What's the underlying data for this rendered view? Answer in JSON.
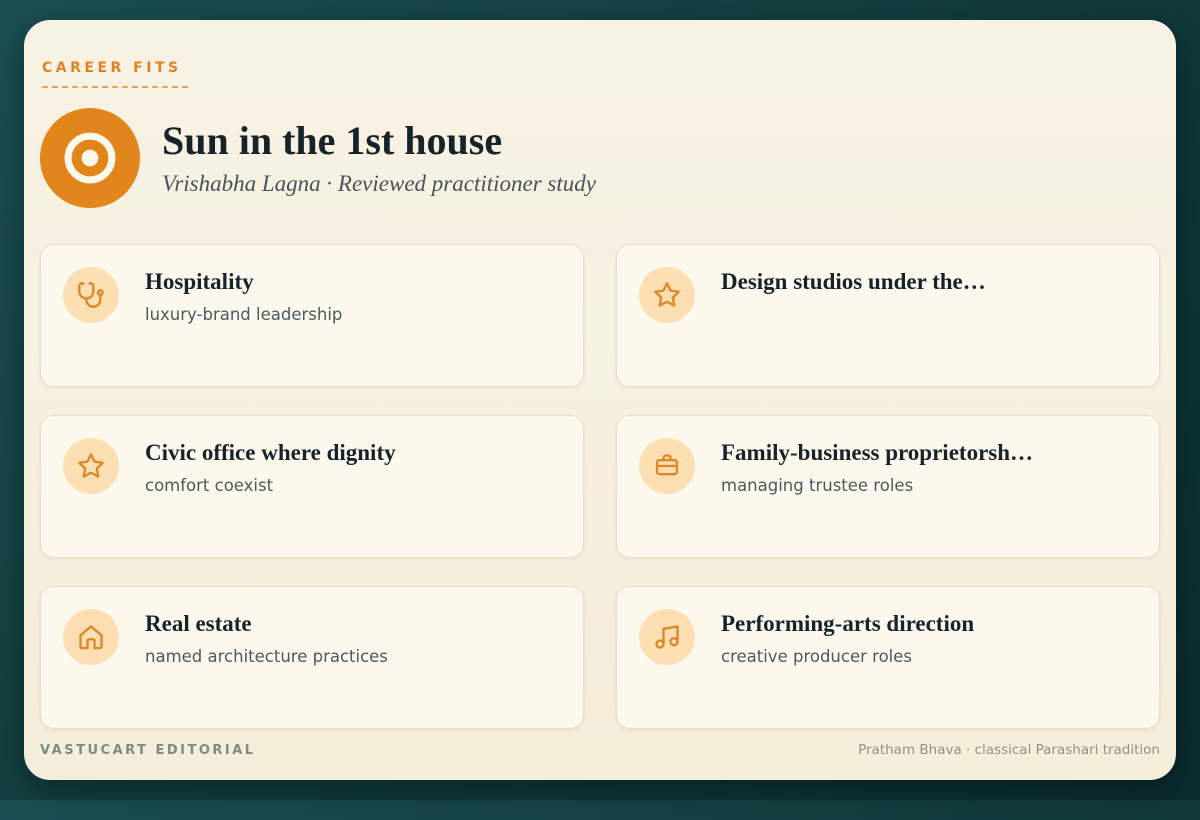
{
  "theme": {
    "accent_orange": "#df8320",
    "icon_stroke": "#dd8824",
    "icon_tile_bg": "#fbdfb2",
    "teal_bg_light": "#1b4f52",
    "teal_bg_dark": "#0b2b2d",
    "board_bg": "#f6f0e1",
    "card_bg": "#fcf8ee",
    "title_color": "#16242a"
  },
  "header": {
    "eyebrow": "CAREER FITS",
    "title": "Sun in the 1st house",
    "subtitle": "Vrishabha Lagna · Reviewed practitioner study",
    "icon": "sun-circle-dot"
  },
  "cards": [
    {
      "icon": "stethoscope",
      "title": "Hospitality",
      "subtitle": "luxury-brand leadership"
    },
    {
      "icon": "star",
      "title": "Design studios under the…",
      "subtitle": ""
    },
    {
      "icon": "star",
      "title": "Civic office where dignity",
      "subtitle": "comfort coexist"
    },
    {
      "icon": "briefcase",
      "title": "Family-business proprietorsh…",
      "subtitle": "managing trustee roles"
    },
    {
      "icon": "home",
      "title": "Real estate",
      "subtitle": "named architecture practices"
    },
    {
      "icon": "music-note",
      "title": "Performing-arts direction",
      "subtitle": "creative producer roles"
    }
  ],
  "footer": {
    "left": "VASTUCART EDITORIAL",
    "right": "Pratham Bhava · classical Parashari tradition"
  }
}
